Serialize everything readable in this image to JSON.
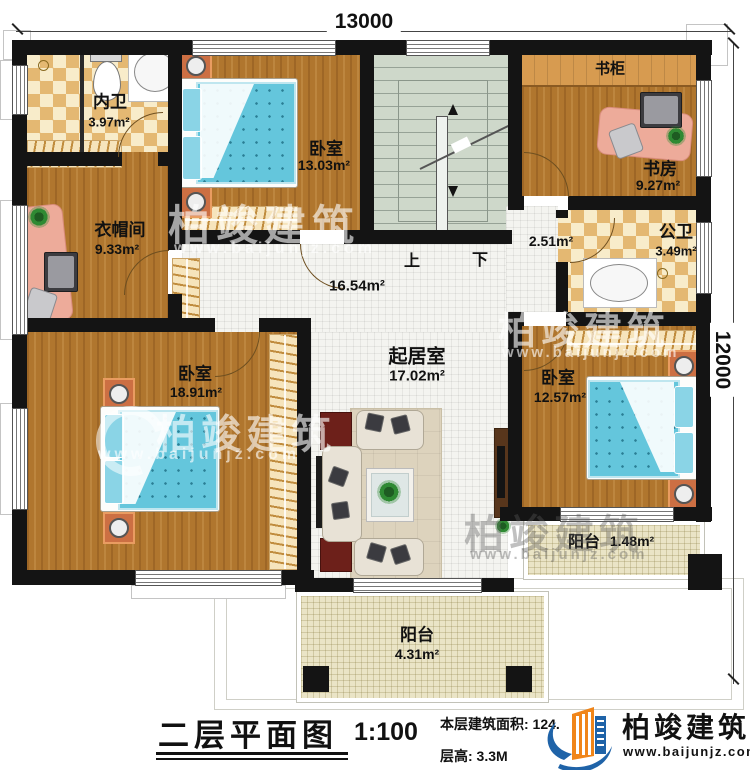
{
  "dimensions": {
    "top": "13000",
    "right": "12000"
  },
  "rooms": {
    "inner_bath": {
      "name": "内卫",
      "area": "3.97m²"
    },
    "bedroom_top": {
      "name": "卧室",
      "area": "13.03m²"
    },
    "cloakroom": {
      "name": "衣帽间",
      "area": "9.33m²"
    },
    "bookcase": {
      "name": "书柜"
    },
    "study": {
      "name": "书房",
      "area": "9.27m²"
    },
    "hallway_small": {
      "area": "2.51m²"
    },
    "public_bath": {
      "name": "公卫",
      "area": "3.49m²"
    },
    "corridor": {
      "area": "16.54m²"
    },
    "living": {
      "name": "起居室",
      "area": "17.02m²"
    },
    "bedroom_left": {
      "name": "卧室",
      "area": "18.91m²"
    },
    "bedroom_right": {
      "name": "卧室",
      "area": "12.57m²"
    },
    "balcony_right": {
      "name": "阳台",
      "area": "1.48m²"
    },
    "balcony_bottom": {
      "name": "阳台",
      "area": "4.31m²"
    }
  },
  "stairs": {
    "up": "上",
    "down": "下"
  },
  "watermark": {
    "brand": "柏竣建筑",
    "url": "www.baijunjz.com"
  },
  "titleblock": {
    "title": "二层平面图",
    "scale": "1:100",
    "area_text": "本层建筑面积: 124.",
    "floor_height": "层高: 3.3M",
    "brand": "柏竣建筑",
    "url": "www.baijunjz.com"
  },
  "colors": {
    "wall": "#141414",
    "wood": "#b0762e",
    "checker": "#e4b872",
    "bed": "#64c6dc",
    "stair": "#ced8ca",
    "balcony": "#eae4c6",
    "logo_blue": "#1f63a8",
    "logo_orange": "#f08519"
  }
}
